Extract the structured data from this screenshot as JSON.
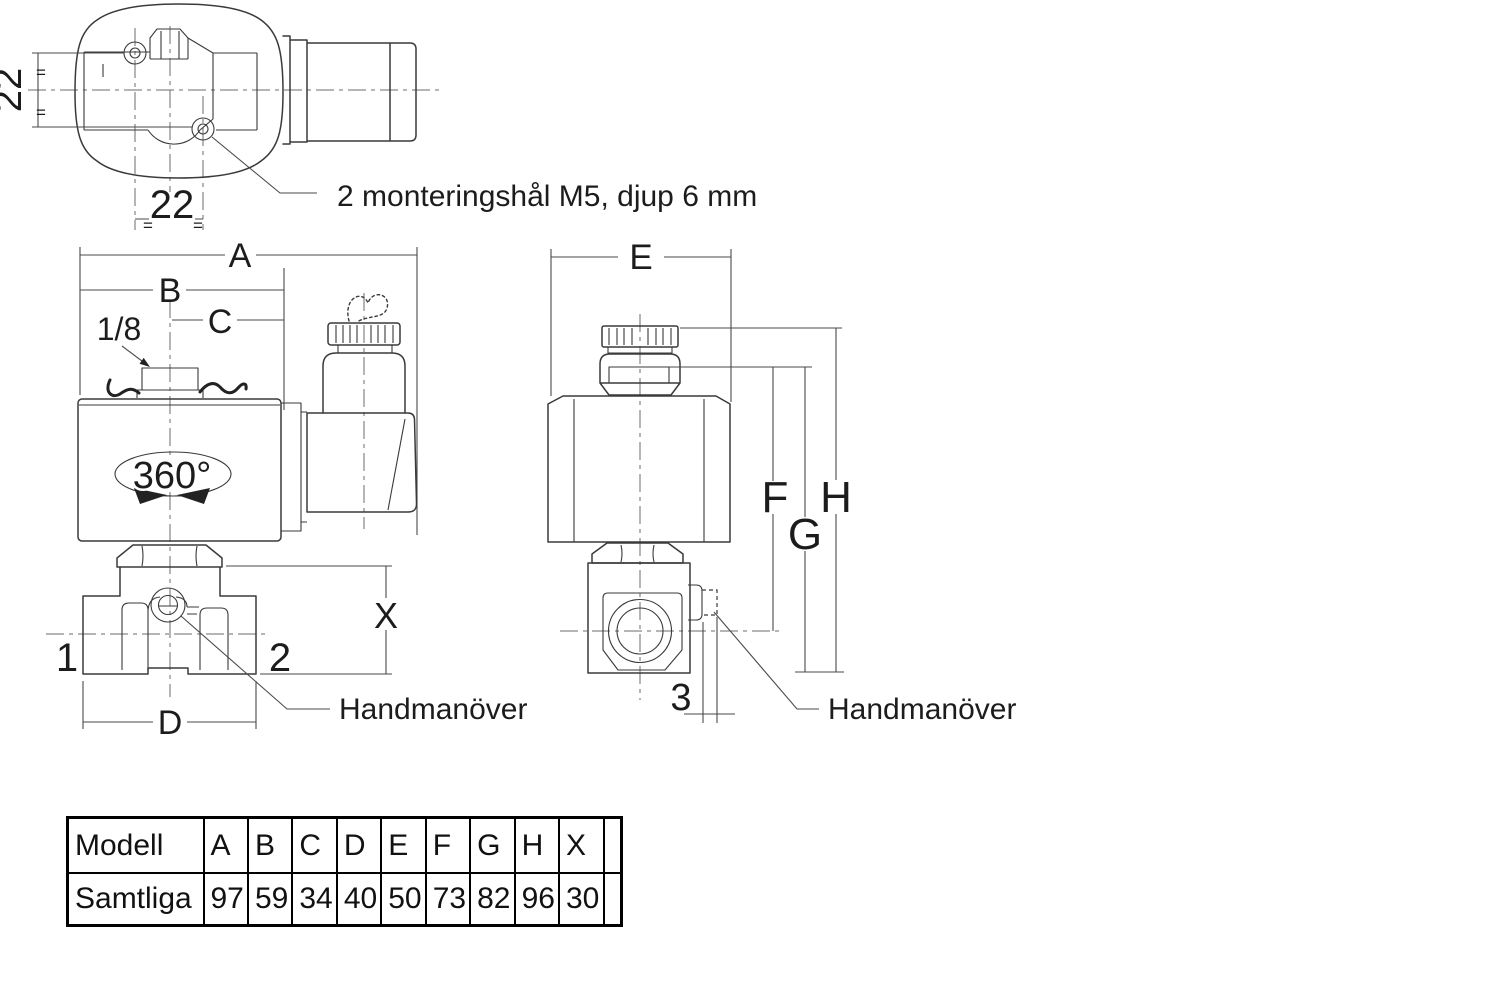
{
  "colors": {
    "line": "#3a3a3a",
    "text": "#1c1c1c",
    "background": "#ffffff"
  },
  "top_view": {
    "dim_height": "22",
    "dim_width": "22",
    "equals_mark": "=",
    "note": "2 monteringshål M5, djup 6 mm"
  },
  "front_view": {
    "dim_a": "A",
    "dim_b": "B",
    "dim_c": "C",
    "dim_d": "D",
    "dim_x": "X",
    "thread_size": "1/8",
    "rotation": "360°",
    "port_inlet": "1",
    "port_outlet": "2",
    "manual_override": "Handmanöver"
  },
  "side_view": {
    "dim_e": "E",
    "dim_f": "F",
    "dim_g": "G",
    "dim_h": "H",
    "dim_3": "3",
    "manual_override": "Handmanöver"
  },
  "table": {
    "headers": [
      "Modell",
      "A",
      "B",
      "C",
      "D",
      "E",
      "F",
      "G",
      "H",
      "X",
      ""
    ],
    "rows": [
      {
        "label": "Samtliga",
        "values": [
          "97",
          "59",
          "34",
          "40",
          "50",
          "73",
          "82",
          "96",
          "30",
          ""
        ]
      }
    ]
  }
}
